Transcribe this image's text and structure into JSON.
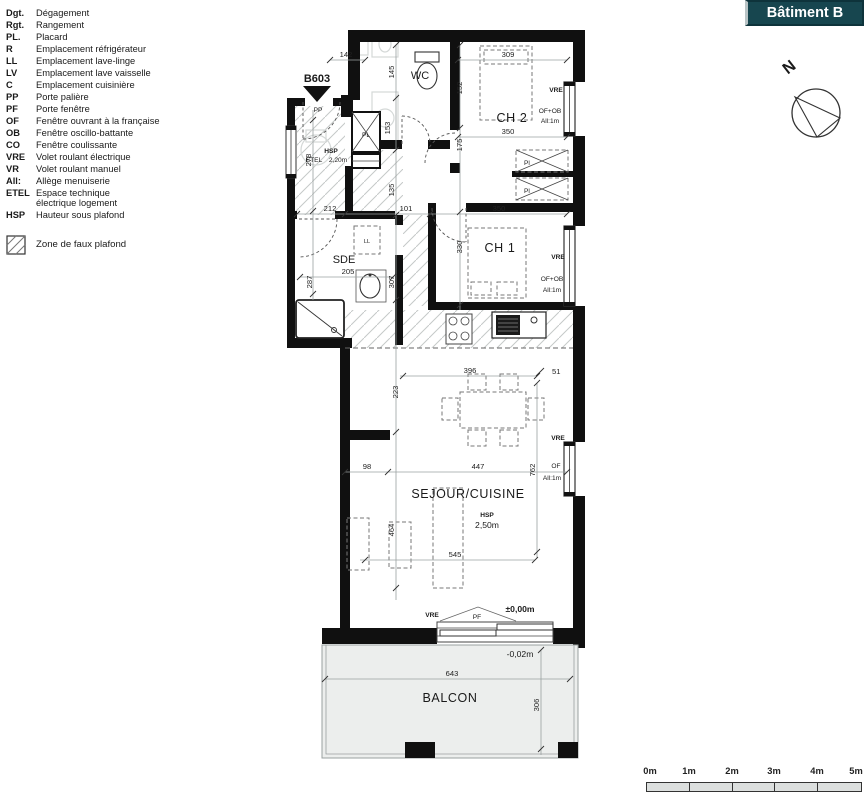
{
  "header": {
    "batiment_label": "Bâtiment B",
    "north_letter": "N",
    "apartment_id": "B603"
  },
  "legend": {
    "items": [
      {
        "abbr": "Dgt.",
        "label": "Dégagement"
      },
      {
        "abbr": "Rgt.",
        "label": "Rangement"
      },
      {
        "abbr": "PL.",
        "label": "Placard"
      },
      {
        "abbr": "R",
        "label": "Emplacement réfrigérateur"
      },
      {
        "abbr": "LL",
        "label": "Emplacement lave-linge"
      },
      {
        "abbr": "LV",
        "label": "Emplacement lave vaisselle"
      },
      {
        "abbr": "C",
        "label": "Emplacement cuisinière"
      },
      {
        "abbr": "PP",
        "label": "Porte palière"
      },
      {
        "abbr": "PF",
        "label": "Porte fenêtre"
      },
      {
        "abbr": "OF",
        "label": "Fenêtre ouvrant à la française"
      },
      {
        "abbr": "OB",
        "label": "Fenêtre oscillo-battante"
      },
      {
        "abbr": "CO",
        "label": "Fenêtre coulissante"
      },
      {
        "abbr": "VRE",
        "label": "Volet roulant électrique"
      },
      {
        "abbr": "VR",
        "label": "Volet roulant manuel"
      },
      {
        "abbr": "All:",
        "label": "Allège menuiserie"
      },
      {
        "abbr": "ETEL",
        "label": "Espace technique\nélectrique logement"
      },
      {
        "abbr": "HSP",
        "label": "Hauteur sous plafond"
      }
    ],
    "zone_label": "Zone de faux plafond"
  },
  "plan": {
    "rooms": {
      "wc": "WC",
      "ch2": "CH 2",
      "ch1": "CH 1",
      "sde": "SDE",
      "sejour": "SEJOUR/CUISINE",
      "balcon": "BALCON"
    },
    "labels": {
      "pp": "PP",
      "pf": "PF",
      "pl": "PL",
      "pl_small": "Pl",
      "ll": "LL",
      "etel": "ETEL",
      "vre": "VRE",
      "of": "OF",
      "of_ob": "OF+OB",
      "all1m": "All:1m",
      "hsp": "HSP",
      "hsp_entry_value": "2,20m",
      "hsp_sejour_value": "2,50m",
      "level_zero": "±0,00m",
      "level_balcony": "-0,02m"
    },
    "dims": {
      "d51": "51",
      "d98": "98",
      "d101": "101",
      "d135": "135",
      "d142": "142",
      "d145": "145",
      "d152": "152",
      "d153": "153",
      "d175": "175",
      "d205": "205",
      "d212": "212",
      "d223": "223",
      "d278": "278",
      "d287": "287",
      "d306": "306",
      "d307": "307",
      "d309": "309",
      "d330": "330",
      "d350": "350",
      "d396": "396",
      "d447": "447",
      "d464": "464",
      "d545": "545",
      "d643": "643",
      "d762": "762"
    }
  },
  "scalebar": {
    "ticks": [
      "0m",
      "1m",
      "2m",
      "3m",
      "4m",
      "5m"
    ]
  },
  "colors": {
    "header_teal": "#17464f",
    "wall_black": "#101010",
    "balcony_fill": "#eceeed",
    "hatch_gray": "#c5c9c8"
  }
}
